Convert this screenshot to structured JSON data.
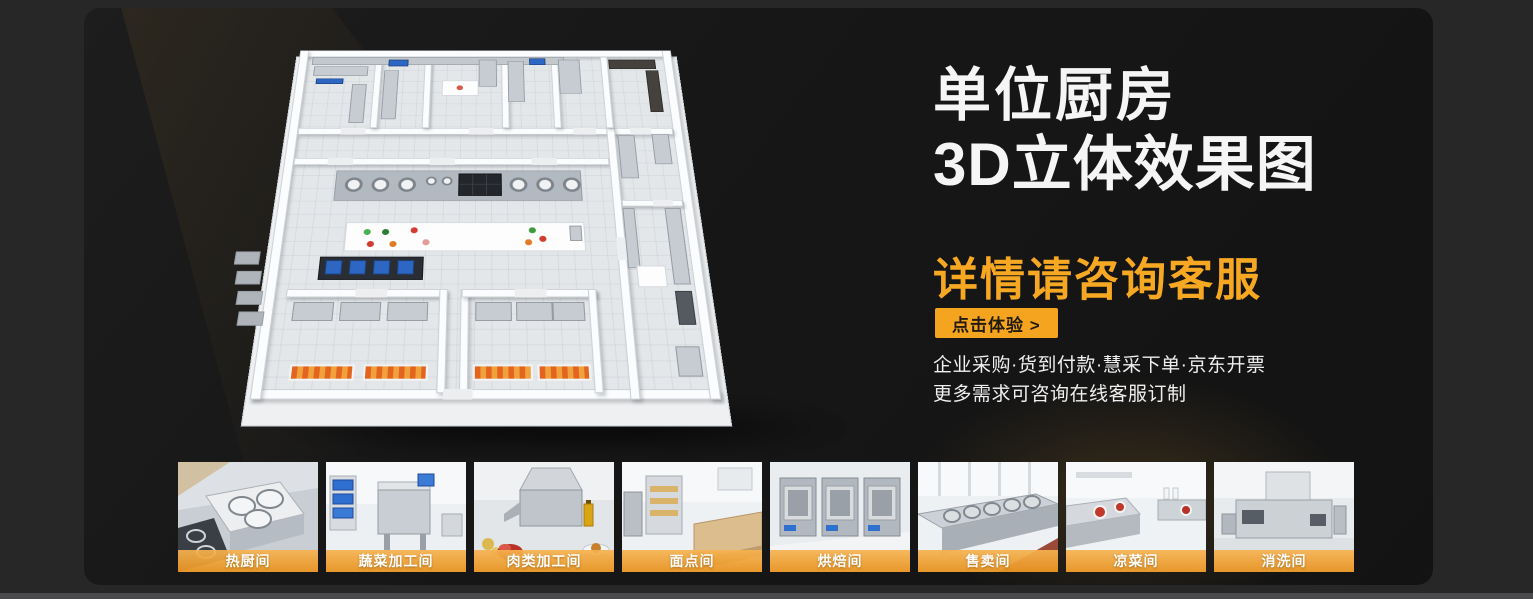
{
  "hero": {
    "title_line1": "单位厨房",
    "title_line2": "3D立体效果图",
    "subtitle": "详情请咨询客服",
    "cta_label": "点击体验 >",
    "notes_line1": "企业采购·货到付款·慧采下单·京东开票",
    "notes_line2": "更多需求可咨询在线客服订制"
  },
  "gallery": {
    "items": [
      {
        "label": "热厨间"
      },
      {
        "label": "蔬菜加工间"
      },
      {
        "label": "肉类加工间"
      },
      {
        "label": "面点间"
      },
      {
        "label": "烘焙间"
      },
      {
        "label": "售卖间"
      },
      {
        "label": "凉菜间"
      },
      {
        "label": "消洗间"
      }
    ]
  },
  "colors": {
    "accent_orange": "#F5A41F",
    "subtitle_orange": "#F7A823",
    "label_bar_orange": "#F0A33C",
    "page_bg": "#272727",
    "panel_bg": "#171717",
    "headline_white": "#F5F5F6"
  }
}
